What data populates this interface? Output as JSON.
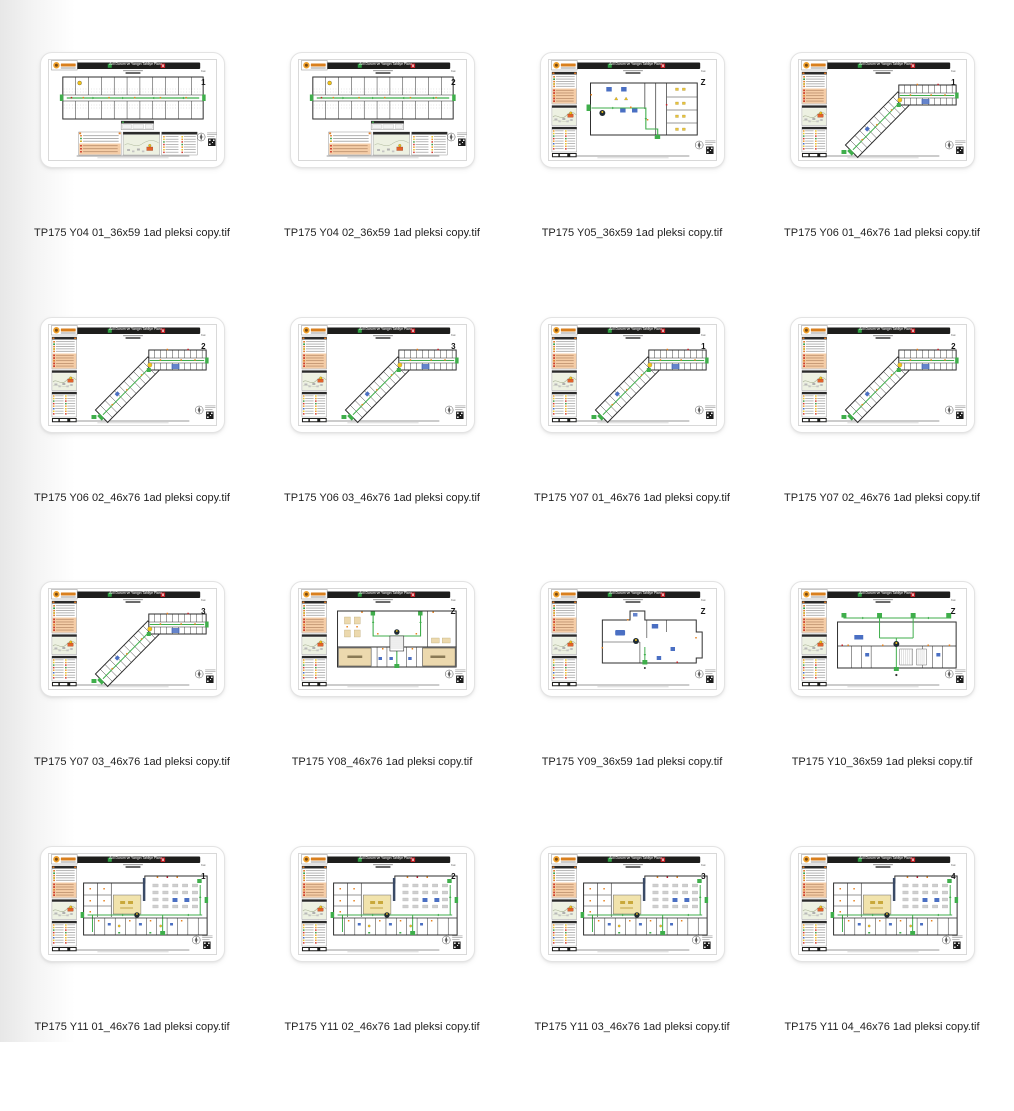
{
  "window": {
    "background": "#ffffff"
  },
  "plan": {
    "header_title": "Acil Durum ve Yangın Tahliye Planı",
    "floor_prefix": "Kat",
    "colors": {
      "header_bar": "#1e1e1c",
      "exit_green": "#3fae4b",
      "alarm_red": "#c42127",
      "legend_orange": "#e07d28",
      "instruction_salmon": "#f5cda7",
      "sitemap_green": "#edf1e2",
      "room_beige": "#ecd9ae",
      "equipment_blue": "#4a6fc3",
      "highlight_yellow": "#f2c318"
    }
  },
  "files": [
    {
      "name": "TP175 Y04 01_36x59 1ad pleksi copy.tif",
      "floor": "1"
    },
    {
      "name": "TP175 Y04 02_36x59 1ad pleksi copy.tif",
      "floor": "2"
    },
    {
      "name": "TP175 Y05_36x59 1ad pleksi copy.tif",
      "floor": "Z"
    },
    {
      "name": "TP175 Y06 01_46x76 1ad pleksi copy.tif",
      "floor": "1"
    },
    {
      "name": "TP175 Y06 02_46x76 1ad pleksi copy.tif",
      "floor": "2"
    },
    {
      "name": "TP175 Y06 03_46x76 1ad pleksi copy.tif",
      "floor": "3"
    },
    {
      "name": "TP175 Y07 01_46x76 1ad pleksi copy.tif",
      "floor": "1"
    },
    {
      "name": "TP175 Y07 02_46x76 1ad pleksi copy.tif",
      "floor": "2"
    },
    {
      "name": "TP175 Y07 03_46x76 1ad pleksi copy.tif",
      "floor": "3"
    },
    {
      "name": "TP175 Y08_46x76 1ad pleksi copy.tif",
      "floor": "Z"
    },
    {
      "name": "TP175 Y09_36x59 1ad pleksi copy.tif",
      "floor": "Z"
    },
    {
      "name": "TP175 Y10_36x59 1ad pleksi copy.tif",
      "floor": "Z"
    },
    {
      "name": "TP175 Y11 01_46x76 1ad pleksi copy.tif",
      "floor": "1"
    },
    {
      "name": "TP175 Y11 02_46x76 1ad pleksi copy.tif",
      "floor": "2"
    },
    {
      "name": "TP175 Y11 03_46x76 1ad pleksi copy.tif",
      "floor": "3"
    },
    {
      "name": "TP175 Y11 04_46x76 1ad pleksi copy.tif",
      "floor": "4"
    }
  ]
}
